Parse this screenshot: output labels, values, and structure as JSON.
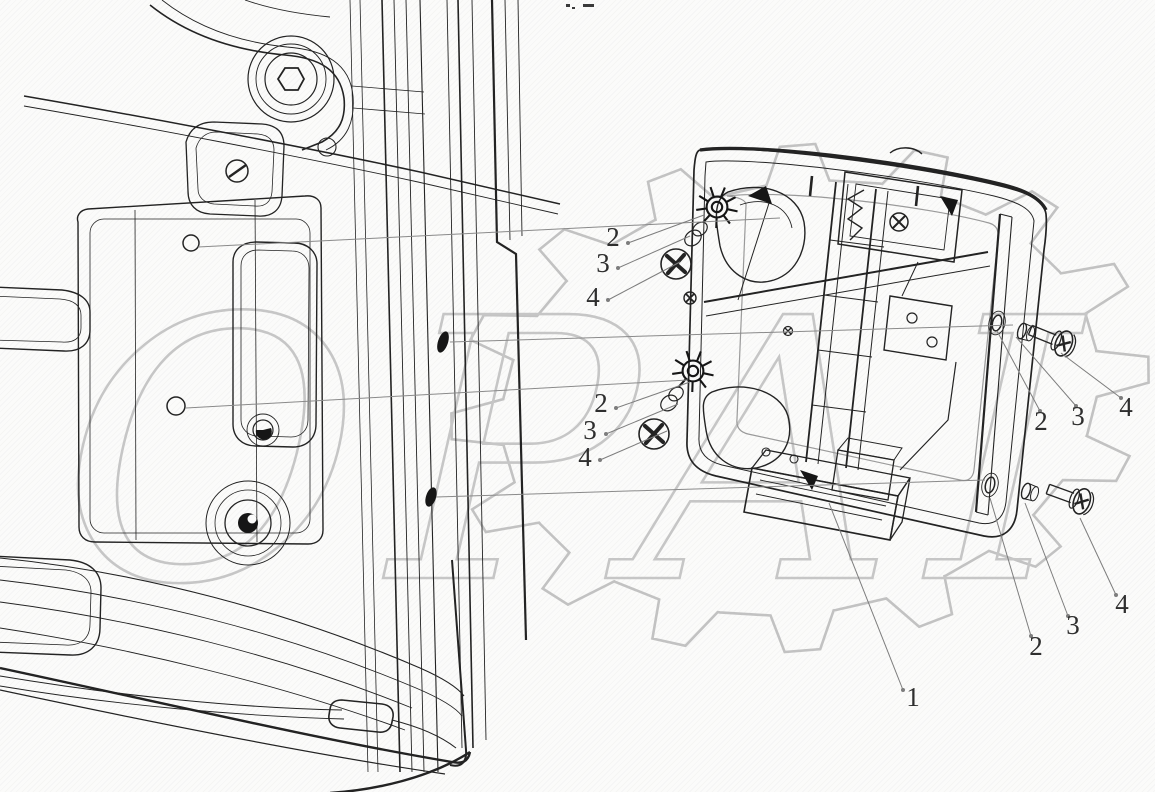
{
  "figure": {
    "watermark_text": "OPAI"
  },
  "callouts": {
    "c1": "1",
    "lt2": "2",
    "lt3": "3",
    "lt4": "4",
    "lm2": "2",
    "lm3": "3",
    "lm4": "4",
    "rt2": "2",
    "rt3": "3",
    "rt4": "4",
    "rb2": "2",
    "rb3": "3",
    "rb4": "4"
  }
}
